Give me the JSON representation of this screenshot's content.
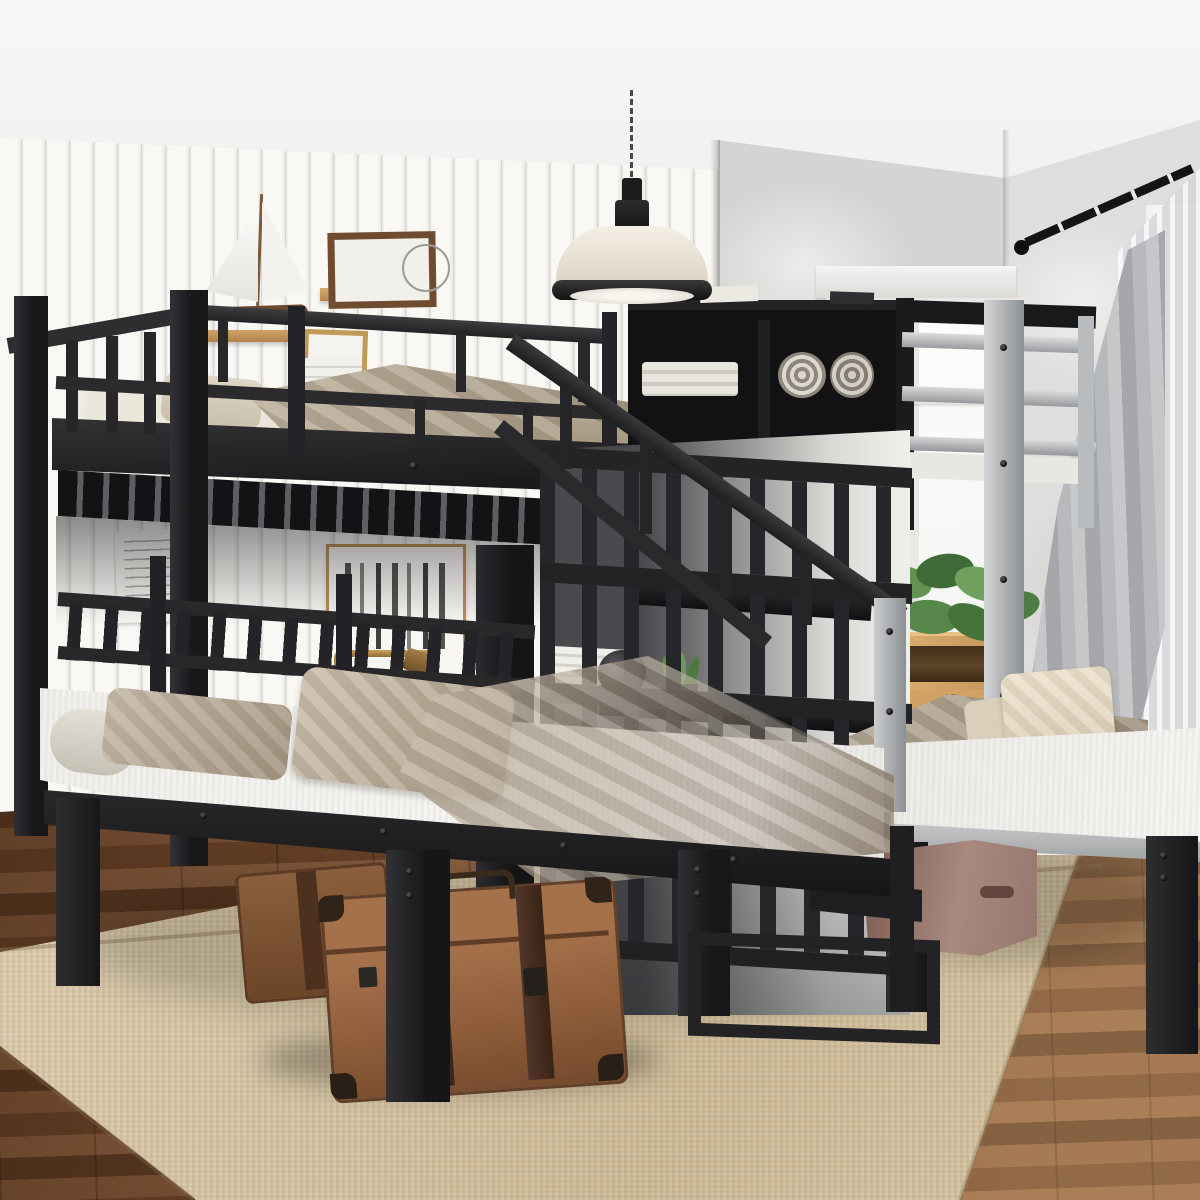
{
  "scene": {
    "type": "product-photo",
    "description": "Black metal triple bunk bed (full over twin and twin) with storage staircase in a bright bedroom",
    "text_visible": "none",
    "palette": {
      "metal_black": "#232325",
      "metal_silver": "#aeb1b3",
      "wall_shiplap": "#f6f5f2",
      "wall_plaster": "#d7d7d5",
      "ceiling": "#f3f3f2",
      "mattress_white": "#f2f1ed",
      "bedding_taupe": "#b3a593",
      "pillow_cream": "#e5dcc7",
      "rug_beige": "#d7c6a6",
      "floor_wood": "#7d5336",
      "shelf_wood": "#c99c63",
      "dresser_oak": "#d8a766",
      "suitcase_brown": "#8b5a39",
      "box_mauve": "#a2837b",
      "curtain_gray": "#b0b2b5",
      "plant_green": "#5d8a4e",
      "lamp_shade": "#efe9df",
      "brass": "#b28a4a"
    },
    "objects": {
      "bunk_bed": "Triple bunk bed with black metal frame, guardrails and staircase",
      "top_bunk": "Full-size top bunk with guardrail and storage bookcase headboard",
      "left_twin_bed": "Twin platform bed with white mattress, taupe pillows and blanket",
      "right_twin_bed": "Twin platform bed with white mattress and cream pillow",
      "staircase": "Black metal staircase with handrails and under-stair shelves",
      "pendant_lamp": "Industrial pendant lamp with white dome shade",
      "sailboat": "Model sailboat on wall shelf",
      "wall_art": "Framed birch-tree print",
      "poster": "Small taped note poster",
      "floor_lamp": "Brass floor lamp",
      "globe": "Glass globe on black nightstand",
      "figurine": "Small gold figurine",
      "dresser": "Oak chest of drawers by the window",
      "plant": "Green houseplant on the windowsill",
      "window": "White-framed window",
      "curtains": "Gray and sheer curtains on a black rod",
      "rug": "Beige woven area rug",
      "floor": "Brown hardwood floor",
      "suitcases": "Two vintage leather suitcases under the left bed",
      "storage_box": "Mauve storage box under the right bed"
    }
  }
}
